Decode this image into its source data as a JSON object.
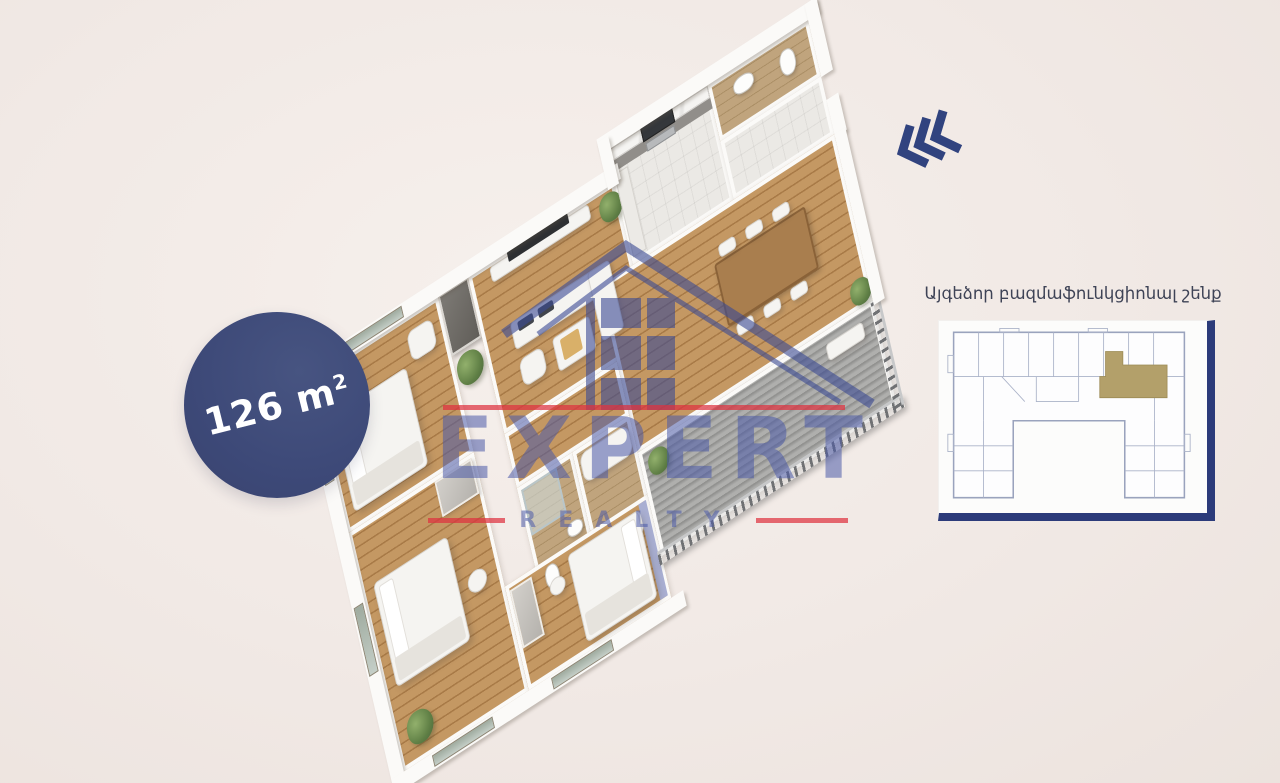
{
  "scene": {
    "background": "#f1e9e5"
  },
  "badge": {
    "area_value": "126 m",
    "area_exponent": "2",
    "bg_color": "#3f4b7c",
    "text_color": "#ffffff"
  },
  "watermark": {
    "brand": "EXPERT",
    "brand_sub": "REALTY",
    "blue": "#4a5aa8",
    "red": "#de3240",
    "logo": "house-roof-logo"
  },
  "chevrons": {
    "icon": "triple-chevron-left",
    "color": "#31437f"
  },
  "inset": {
    "title": "Այգեձոր բազմաֆունկցիոնալ շենք",
    "panel_bg": "#fcfcfb",
    "frame_color": "#2c3b7a",
    "plan_line_color": "#a9b1c6",
    "highlight_color": "#b3a06a"
  },
  "floorplan": {
    "type": "3d-apartment-floor-plan",
    "rooms": [
      "bedroom-1",
      "living-room",
      "kitchen",
      "entry-hall",
      "guest-bathroom",
      "hallway",
      "bathroom-1",
      "bathroom-2",
      "dining-area",
      "bedroom-2",
      "bedroom-3",
      "balcony"
    ],
    "colors": {
      "wood_floor": "#bd8f59",
      "tile_floor": "#b89c74",
      "pale_floor": "#ebe9e5",
      "deck_floor": "#a6a6a4",
      "walls": "#fbfaf8",
      "accent_wall": "#a9afd2",
      "plant": "#6a8c4e"
    }
  }
}
